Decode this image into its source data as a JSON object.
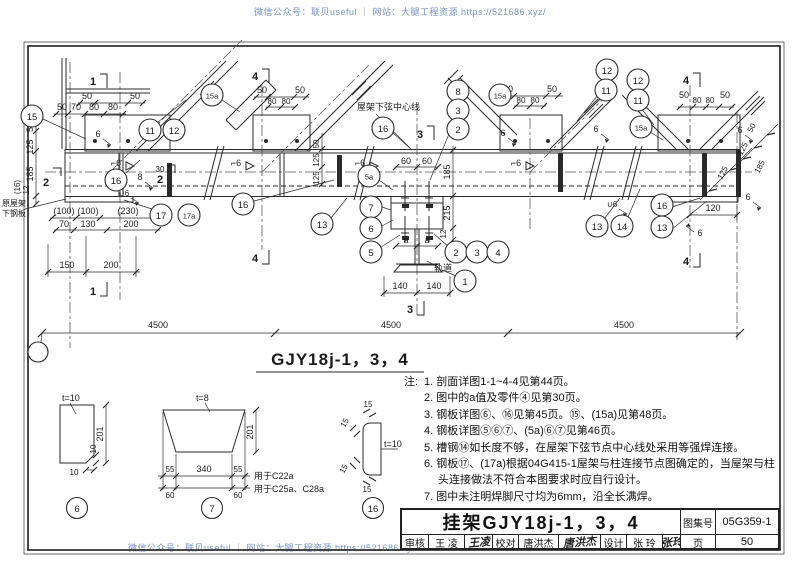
{
  "watermark": {
    "top": "微信公众号：联贝useful ｜ 网站：大腿工程资源 https://521686.xyz/",
    "bottom": "微信公众号：联贝useful ｜ 网站：大腿工程资源 https://521686.xyz/"
  },
  "elev": {
    "title": "GJY18j-1，3，4",
    "chord_centerline_label": "屋架下弦中心线",
    "rail_label": "轨道",
    "existing_plate_label_line1": "原屋架",
    "existing_plate_label_line2": "下钢板",
    "span": "4500",
    "callout": {
      "1": "1",
      "2": "2",
      "3": "3",
      "4": "4",
      "5": "5",
      "5a": "5a",
      "6": "6",
      "7": "7",
      "8": "8",
      "11": "11",
      "12": "12",
      "13": "13",
      "14": "14",
      "15": "15",
      "15a": "15a",
      "16": "16",
      "17": "17",
      "17a": "17a"
    },
    "section": {
      "1": "1",
      "2": "2",
      "3": "3",
      "4": "4"
    },
    "weld": {
      "fillet6": "6",
      "flare6": "⌐6",
      "u6": "∪6",
      "fillet8": "8"
    },
    "dim": {
      "50": "50",
      "70": "70",
      "80": "80",
      "125": "125",
      "185": "185",
      "12": "12",
      "30": "30",
      "60": "60",
      "215": "215",
      "a": "a",
      "140": "140",
      "120": "120",
      "100p": "(100)",
      "230p": "(230)",
      "130": "130",
      "200": "200",
      "150": "150",
      "16p": "(16)"
    }
  },
  "details": {
    "d6": {
      "num": "6",
      "t": "t=10",
      "h": "201",
      "cut": "10",
      "cut2": "10"
    },
    "d7": {
      "num": "7",
      "t": "t=8",
      "h": "201",
      "e55": "55",
      "mid": "340",
      "e60": "60",
      "use_c22a": "用于C22a",
      "use_c25a": "用于C25a、C28a"
    },
    "d16": {
      "num": "16",
      "t": "t=10",
      "r": "15"
    }
  },
  "notes": {
    "prefix": "注:",
    "items": [
      "1. 剖面详图1-1~4-4见第44页。",
      "2. 图中的a值及零件④见第30页。",
      "3. 钢板详图⑥、⑯见第45页。⑮、(15a)见第48页。",
      "4. 钢板详图⑤⑥⑦、(5a)⑥⑦见第46页。",
      "5. 槽钢⑭如长度不够，在屋架下弦节点中心线处采用等强焊连接。",
      "6. 钢板⑰、(17a)根据04G415-1屋架与柱连接节点图确定的，当屋架与柱头连接做法不符合本图要求时应自行设计。",
      "7. 图中未注明焊脚尺寸均为6mm，沿全长满焊。"
    ]
  },
  "title_block": {
    "title": "挂架GJY18j-1，3，4",
    "atlas_label": "图集号",
    "atlas_value": "05G359-1",
    "page_label": "页",
    "page_value": "50",
    "review_label": "审核",
    "review_name": "王 凌",
    "review_sig": "王凌",
    "check_label": "校对",
    "check_name": "唐洪杰",
    "check_sig": "唐洪杰",
    "design_label": "设计",
    "design_name": "张 玲",
    "design_sig": "张玲"
  }
}
